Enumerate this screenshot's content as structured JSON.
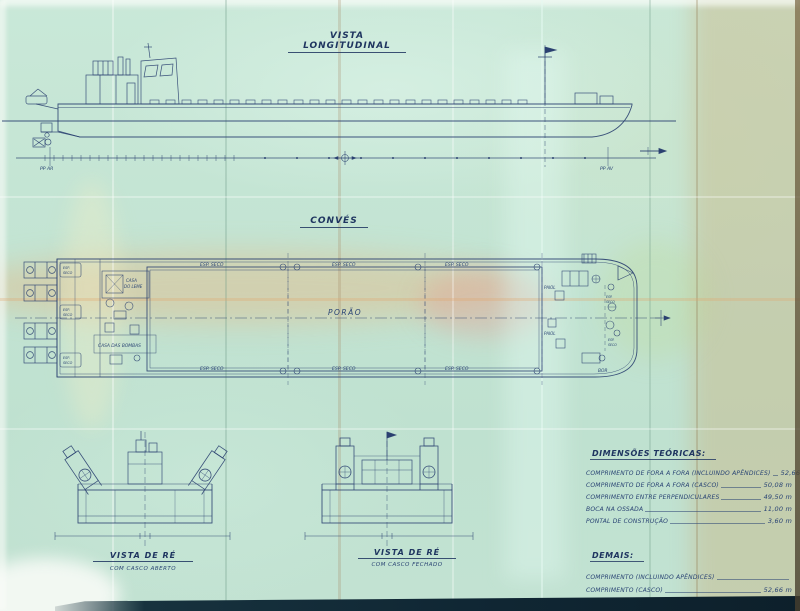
{
  "colors": {
    "ink": "#27406e",
    "paper": "#c6e6d6"
  },
  "longitudinal_view": {
    "title": "VISTA LONGITUDINAL",
    "pp_ar": "PP AR",
    "pp_av": "PP AV"
  },
  "deck_view": {
    "title": "CONVÉS",
    "hold": "PORÃO",
    "dry_space": "ESP. SECO",
    "esp": "ESP.",
    "seco": "SECO",
    "rudder_room_line1": "CASA",
    "rudder_room_line2": "DO LEME",
    "pump_room": "CASA DAS BOMBAS",
    "storeroom": "PAIOL",
    "starboard_abbr": "BOR"
  },
  "stern_views": {
    "open": {
      "title": "VISTA DE RÉ",
      "subtitle": "COM CASCO ABERTO"
    },
    "closed": {
      "title": "VISTA DE RÉ",
      "subtitle": "COM CASCO FECHADO"
    }
  },
  "tables": {
    "main": {
      "title": "DIMENSÕES TEÓRICAS:",
      "rows": [
        {
          "label": "COMPRIMENTO DE FORA A FORA (INCLUINDO APÊNDICES)",
          "value": "52,66 m"
        },
        {
          "label": "COMPRIMENTO DE FORA A FORA (CASCO)",
          "value": "50,08 m"
        },
        {
          "label": "COMPRIMENTO ENTRE PERPENDICULARES",
          "value": "49,50 m"
        },
        {
          "label": "BOCA NA OSSADA",
          "value": "11,00 m"
        },
        {
          "label": "PONTAL DE CONSTRUÇÃO",
          "value": "3,60 m"
        }
      ]
    },
    "secondary": {
      "title": "DEMAIS:",
      "rows": [
        {
          "label": "COMPRIMENTO (INCLUINDO APÊNDICES)",
          "value": ""
        },
        {
          "label": "COMPRIMENTO (CASCO)",
          "value": "52,66 m"
        },
        {
          "label": "COMPRIMENTO CONVÉS",
          "value": "50,08 m"
        },
        {
          "label": "BOCA NA OSSADA",
          "value": "49,50 m"
        }
      ]
    }
  }
}
